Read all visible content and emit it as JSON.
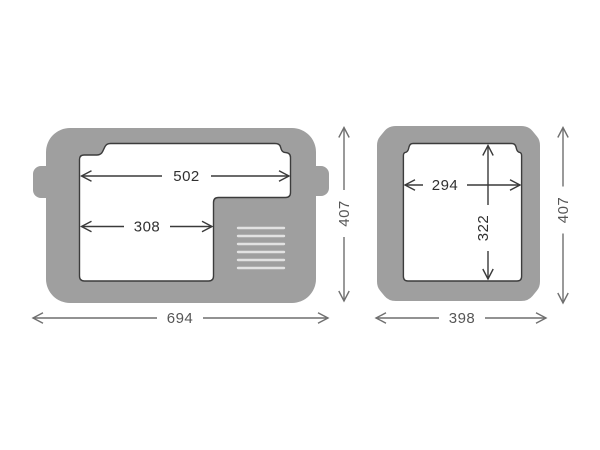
{
  "diagram": {
    "description": "Cooler dimension drawing, two orthographic views",
    "colors": {
      "body": "#9f9f9f",
      "interior_outline": "#3c3c3c",
      "inner_dimension": "#3a3a3a",
      "outer_dimension": "#6f6f6f",
      "vent": "#e2e2e2",
      "background": "#ffffff"
    },
    "side_view": {
      "interior_top_width": "502",
      "interior_bottom_width": "308",
      "overall_width": "694",
      "overall_height": "407",
      "vent_slat_count": 6
    },
    "front_view": {
      "interior_width": "294",
      "interior_depth": "322",
      "overall_width": "398",
      "overall_height": "407"
    }
  }
}
